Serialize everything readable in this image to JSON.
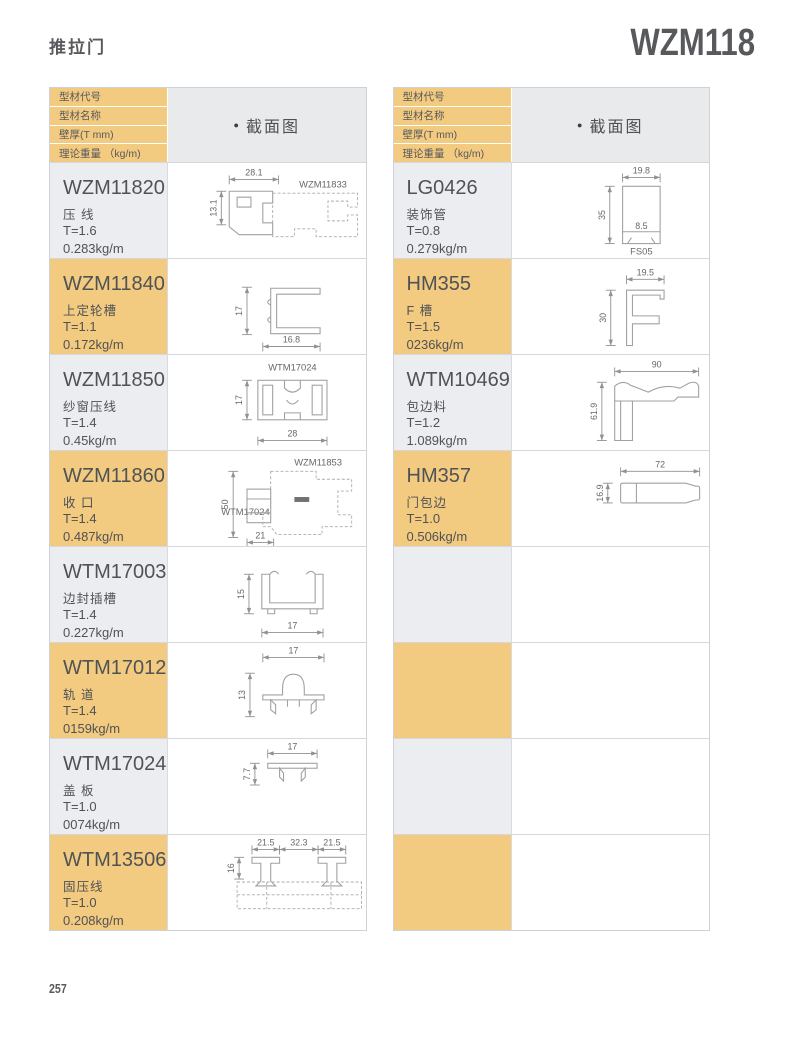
{
  "header": {
    "title": "推拉门",
    "model": "WZM118"
  },
  "footer": {
    "page_number": "257"
  },
  "colors": {
    "accent_orange": "#f2ca80",
    "row_gray": "#ebedf0",
    "header_gray": "#e8eaec"
  },
  "table_header": {
    "bullet": "●",
    "col_labels": [
      "型材代号",
      "型材名称",
      "壁厚(T mm)",
      "理论重量 （kg/m)"
    ],
    "section": "截面图"
  },
  "left_table": {
    "rows": [
      {
        "code": "WZM11820",
        "name": "压 线",
        "thickness": "T=1.6",
        "weight": "0.283kg/m",
        "highlight": false,
        "diagram": {
          "type": "wzm11820",
          "labels": {
            "part": "WZM11833"
          },
          "dims": {
            "top": "28.1",
            "left": "13.1"
          }
        }
      },
      {
        "code": "WZM11840",
        "name": "上定轮槽",
        "thickness": "T=1.1",
        "weight": "0.172kg/m",
        "highlight": true,
        "diagram": {
          "type": "wzm11840",
          "labels": {},
          "dims": {
            "left": "17",
            "bottom": "16.8"
          }
        }
      },
      {
        "code": "WZM11850",
        "name": "纱窗压线",
        "thickness": "T=1.4",
        "weight": "0.45kg/m",
        "highlight": false,
        "diagram": {
          "type": "wzm11850",
          "labels": {
            "part": "WTM17024"
          },
          "dims": {
            "left": "17",
            "bottom": "28"
          }
        }
      },
      {
        "code": "WZM11860",
        "name": "收 口",
        "thickness": "T=1.4",
        "weight": "0.487kg/m",
        "highlight": true,
        "diagram": {
          "type": "wzm11860",
          "labels": {
            "part_top": "WZM11853",
            "part_left": "WTM17024"
          },
          "dims": {
            "left": "50",
            "bottom": "21"
          }
        }
      },
      {
        "code": "WTM17003",
        "name": "边封插槽",
        "thickness": "T=1.4",
        "weight": "0.227kg/m",
        "highlight": false,
        "diagram": {
          "type": "wtm17003",
          "labels": {},
          "dims": {
            "left": "15",
            "bottom": "17"
          }
        }
      },
      {
        "code": "WTM17012",
        "name": "轨 道",
        "thickness": "T=1.4",
        "weight": "0159kg/m",
        "highlight": true,
        "diagram": {
          "type": "wtm17012",
          "labels": {},
          "dims": {
            "top": "17",
            "left": "13"
          }
        }
      },
      {
        "code": "WTM17024",
        "name": "盖 板",
        "thickness": "T=1.0",
        "weight": "0074kg/m",
        "highlight": false,
        "diagram": {
          "type": "wtm17024",
          "labels": {},
          "dims": {
            "top": "17",
            "left": "7.7"
          }
        }
      },
      {
        "code": "WTM13506",
        "name": "固压线",
        "thickness": "T=1.0",
        "weight": "0.208kg/m",
        "highlight": true,
        "diagram": {
          "type": "wtm13506",
          "labels": {},
          "dims": {
            "top1": "21.5",
            "top2": "32.3",
            "top3": "21.5",
            "left": "16"
          }
        }
      }
    ]
  },
  "right_table": {
    "rows": [
      {
        "code": "LG0426",
        "name": "装饰管",
        "thickness": "T=0.8",
        "weight": "0.279kg/m",
        "highlight": false,
        "diagram": {
          "type": "lg0426",
          "labels": {
            "bottom": "FS05"
          },
          "dims": {
            "top": "19.8",
            "left": "35",
            "inner": "8.5"
          }
        }
      },
      {
        "code": "HM355",
        "name": "F 槽",
        "thickness": "T=1.5",
        "weight": "0236kg/m",
        "highlight": true,
        "diagram": {
          "type": "hm355",
          "labels": {},
          "dims": {
            "top": "19.5",
            "left": "30"
          }
        }
      },
      {
        "code": "WTM10469",
        "name": "包边料",
        "thickness": "T=1.2",
        "weight": "1.089kg/m",
        "highlight": false,
        "diagram": {
          "type": "wtm10469",
          "labels": {},
          "dims": {
            "top": "90",
            "left": "61.9"
          }
        }
      },
      {
        "code": "HM357",
        "name": "门包边",
        "thickness": "T=1.0",
        "weight": "0.506kg/m",
        "highlight": true,
        "diagram": {
          "type": "hm357",
          "labels": {},
          "dims": {
            "top": "72",
            "left": "16.9"
          }
        }
      },
      {
        "empty": true,
        "highlight": false
      },
      {
        "empty": true,
        "highlight": true
      },
      {
        "empty": true,
        "highlight": false
      },
      {
        "empty": true,
        "highlight": true
      }
    ]
  }
}
